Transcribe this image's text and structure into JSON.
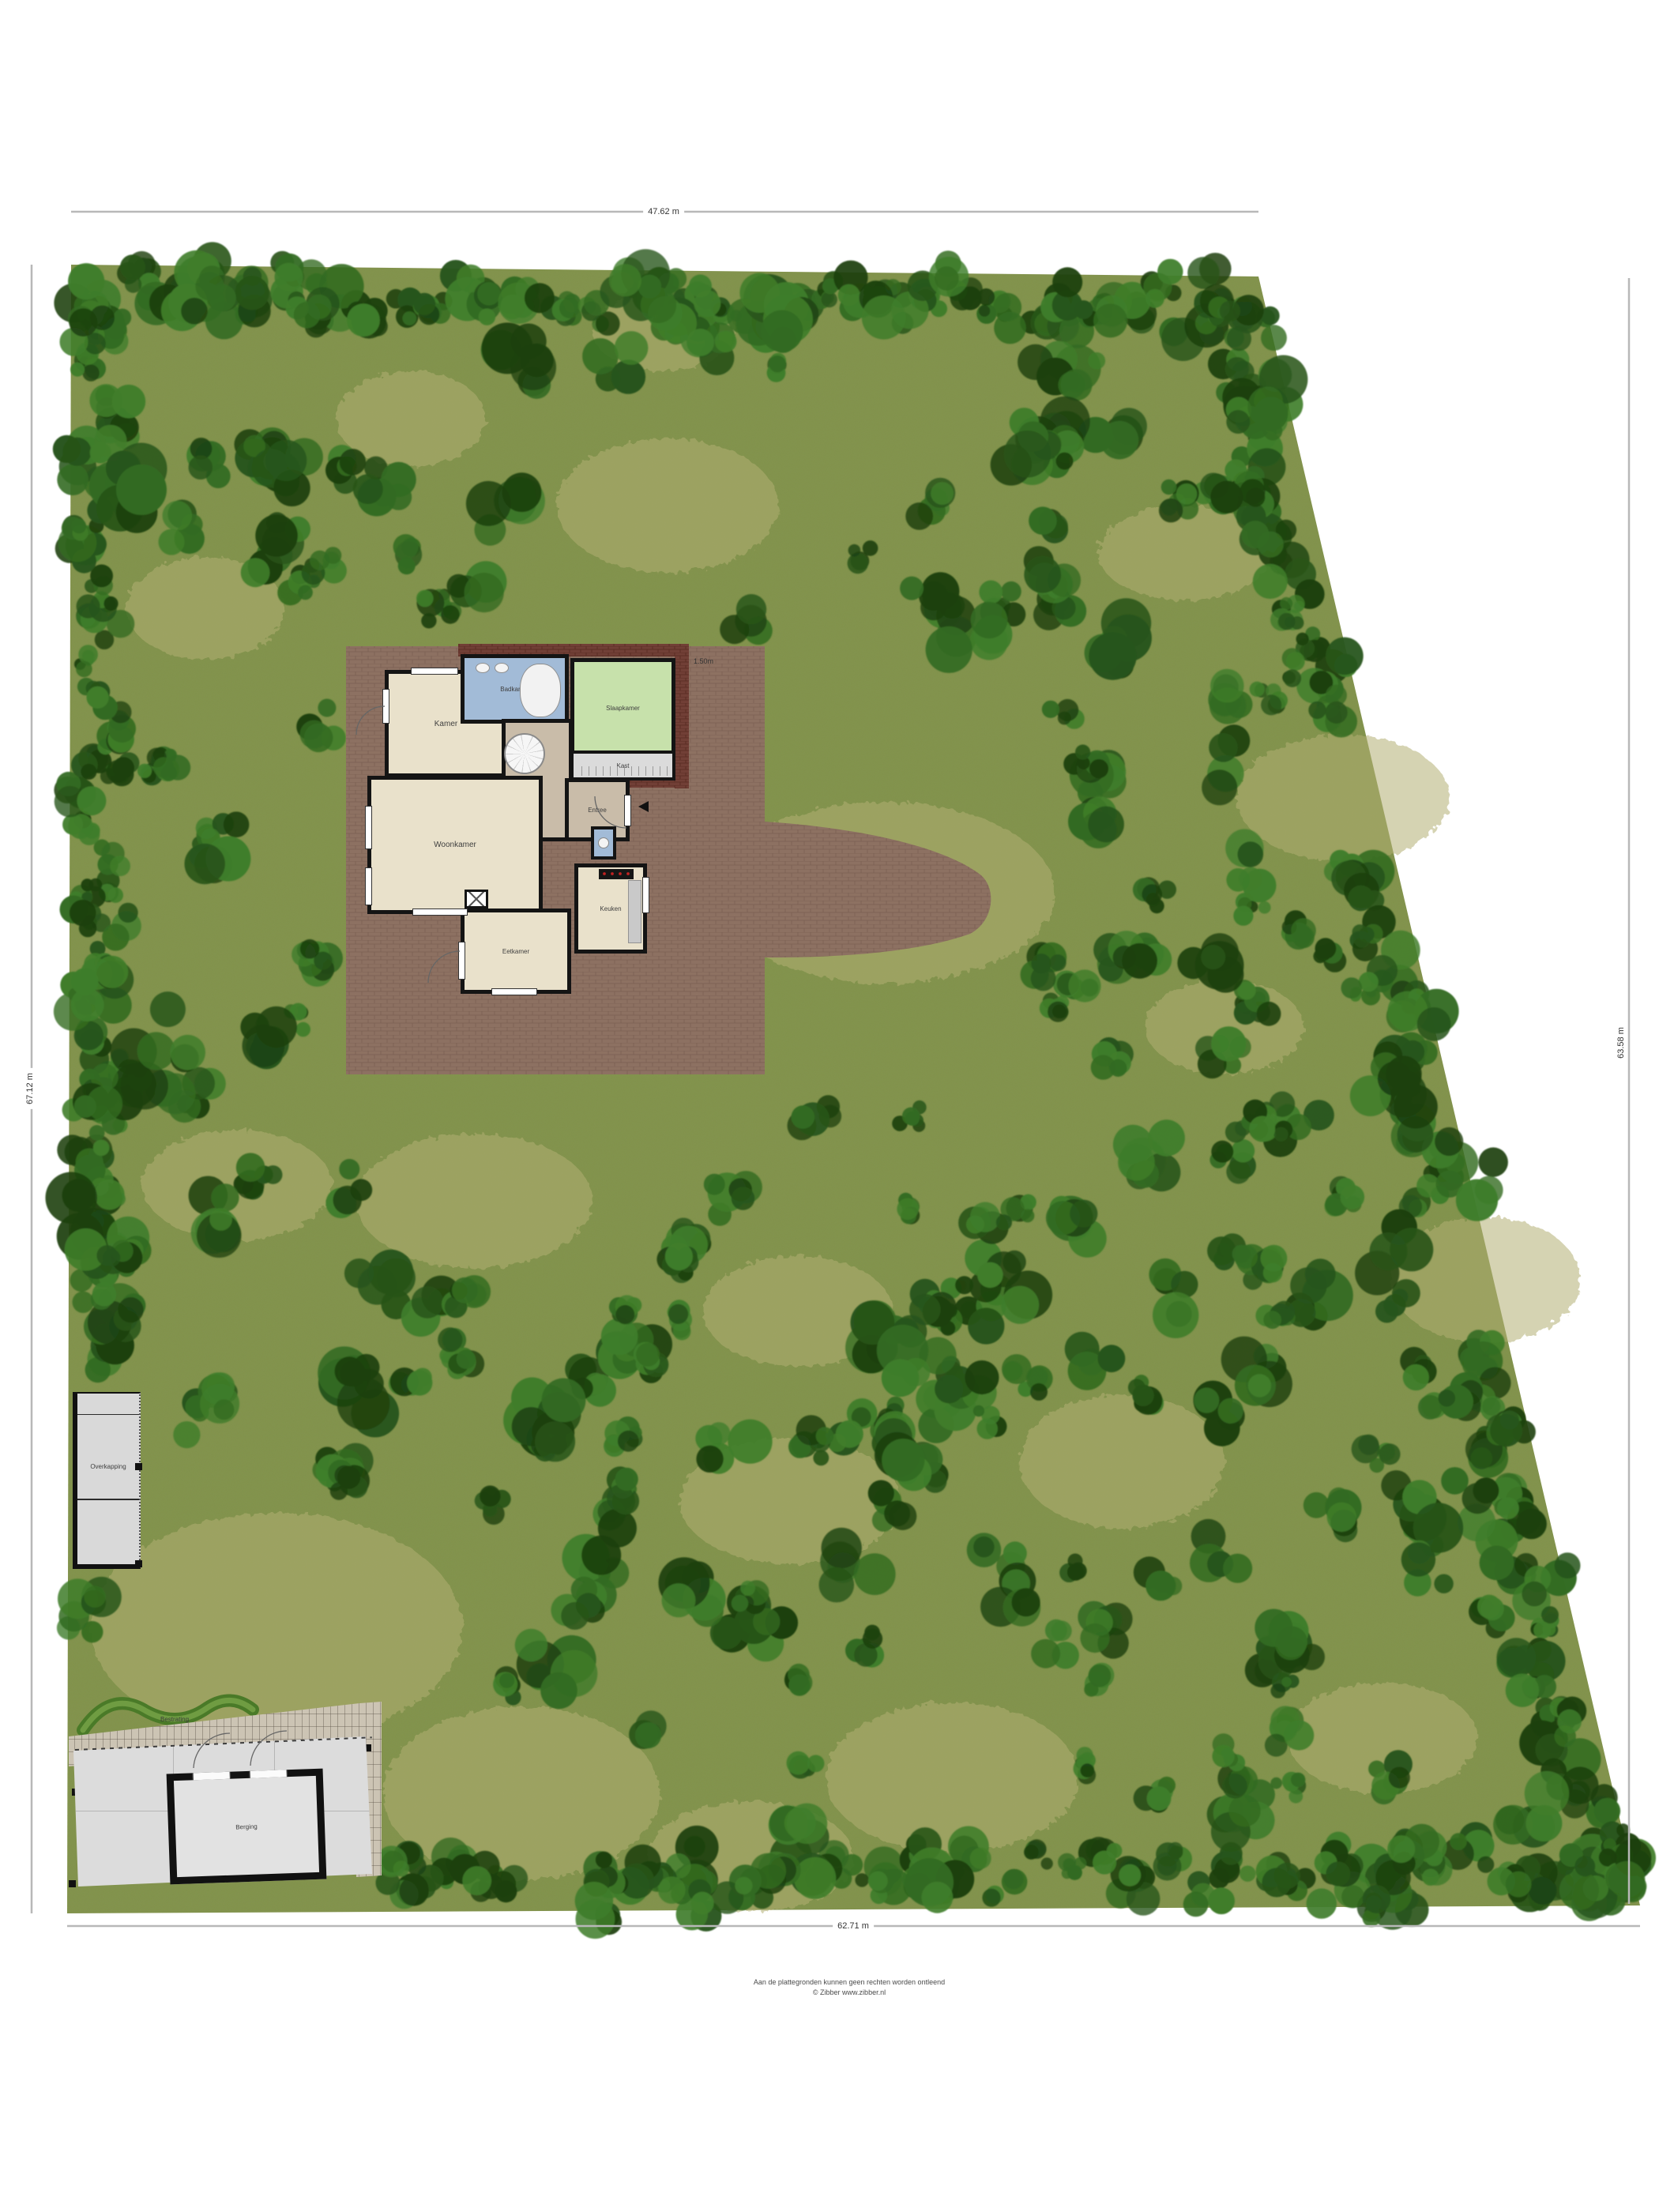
{
  "dimensions": {
    "top": "47.62 m",
    "bottom": "62.71 m",
    "left": "67.12 m",
    "right": "63.58 m"
  },
  "house": {
    "rooms": [
      {
        "label": "Kamer"
      },
      {
        "label": "Badkamer"
      },
      {
        "label": "Slaapkamer"
      },
      {
        "label": "Kast"
      },
      {
        "label": "Entree"
      },
      {
        "label": "Woonkamer"
      },
      {
        "label": "Eetkamer"
      },
      {
        "label": "Keuken"
      }
    ],
    "annotation": "1.50m"
  },
  "outbuildings": {
    "overkapping": "Overkapping",
    "bestrating": "Bestrating",
    "berging": "Berging"
  },
  "footer": {
    "line1": "Aan de plattegronden kunnen geen rechten worden ontleend",
    "line2": "© Zibber www.zibber.nl"
  },
  "colors": {
    "grass": "#84934e",
    "grass_light": "#b2ae73",
    "tree_dark": "#27541a",
    "tree_mid": "#336b21",
    "tree_light": "#3f7d2a",
    "tree_deep": "#1d4110",
    "terrace": "#8d7162",
    "roof": "#713f36",
    "wall": "#141414"
  }
}
